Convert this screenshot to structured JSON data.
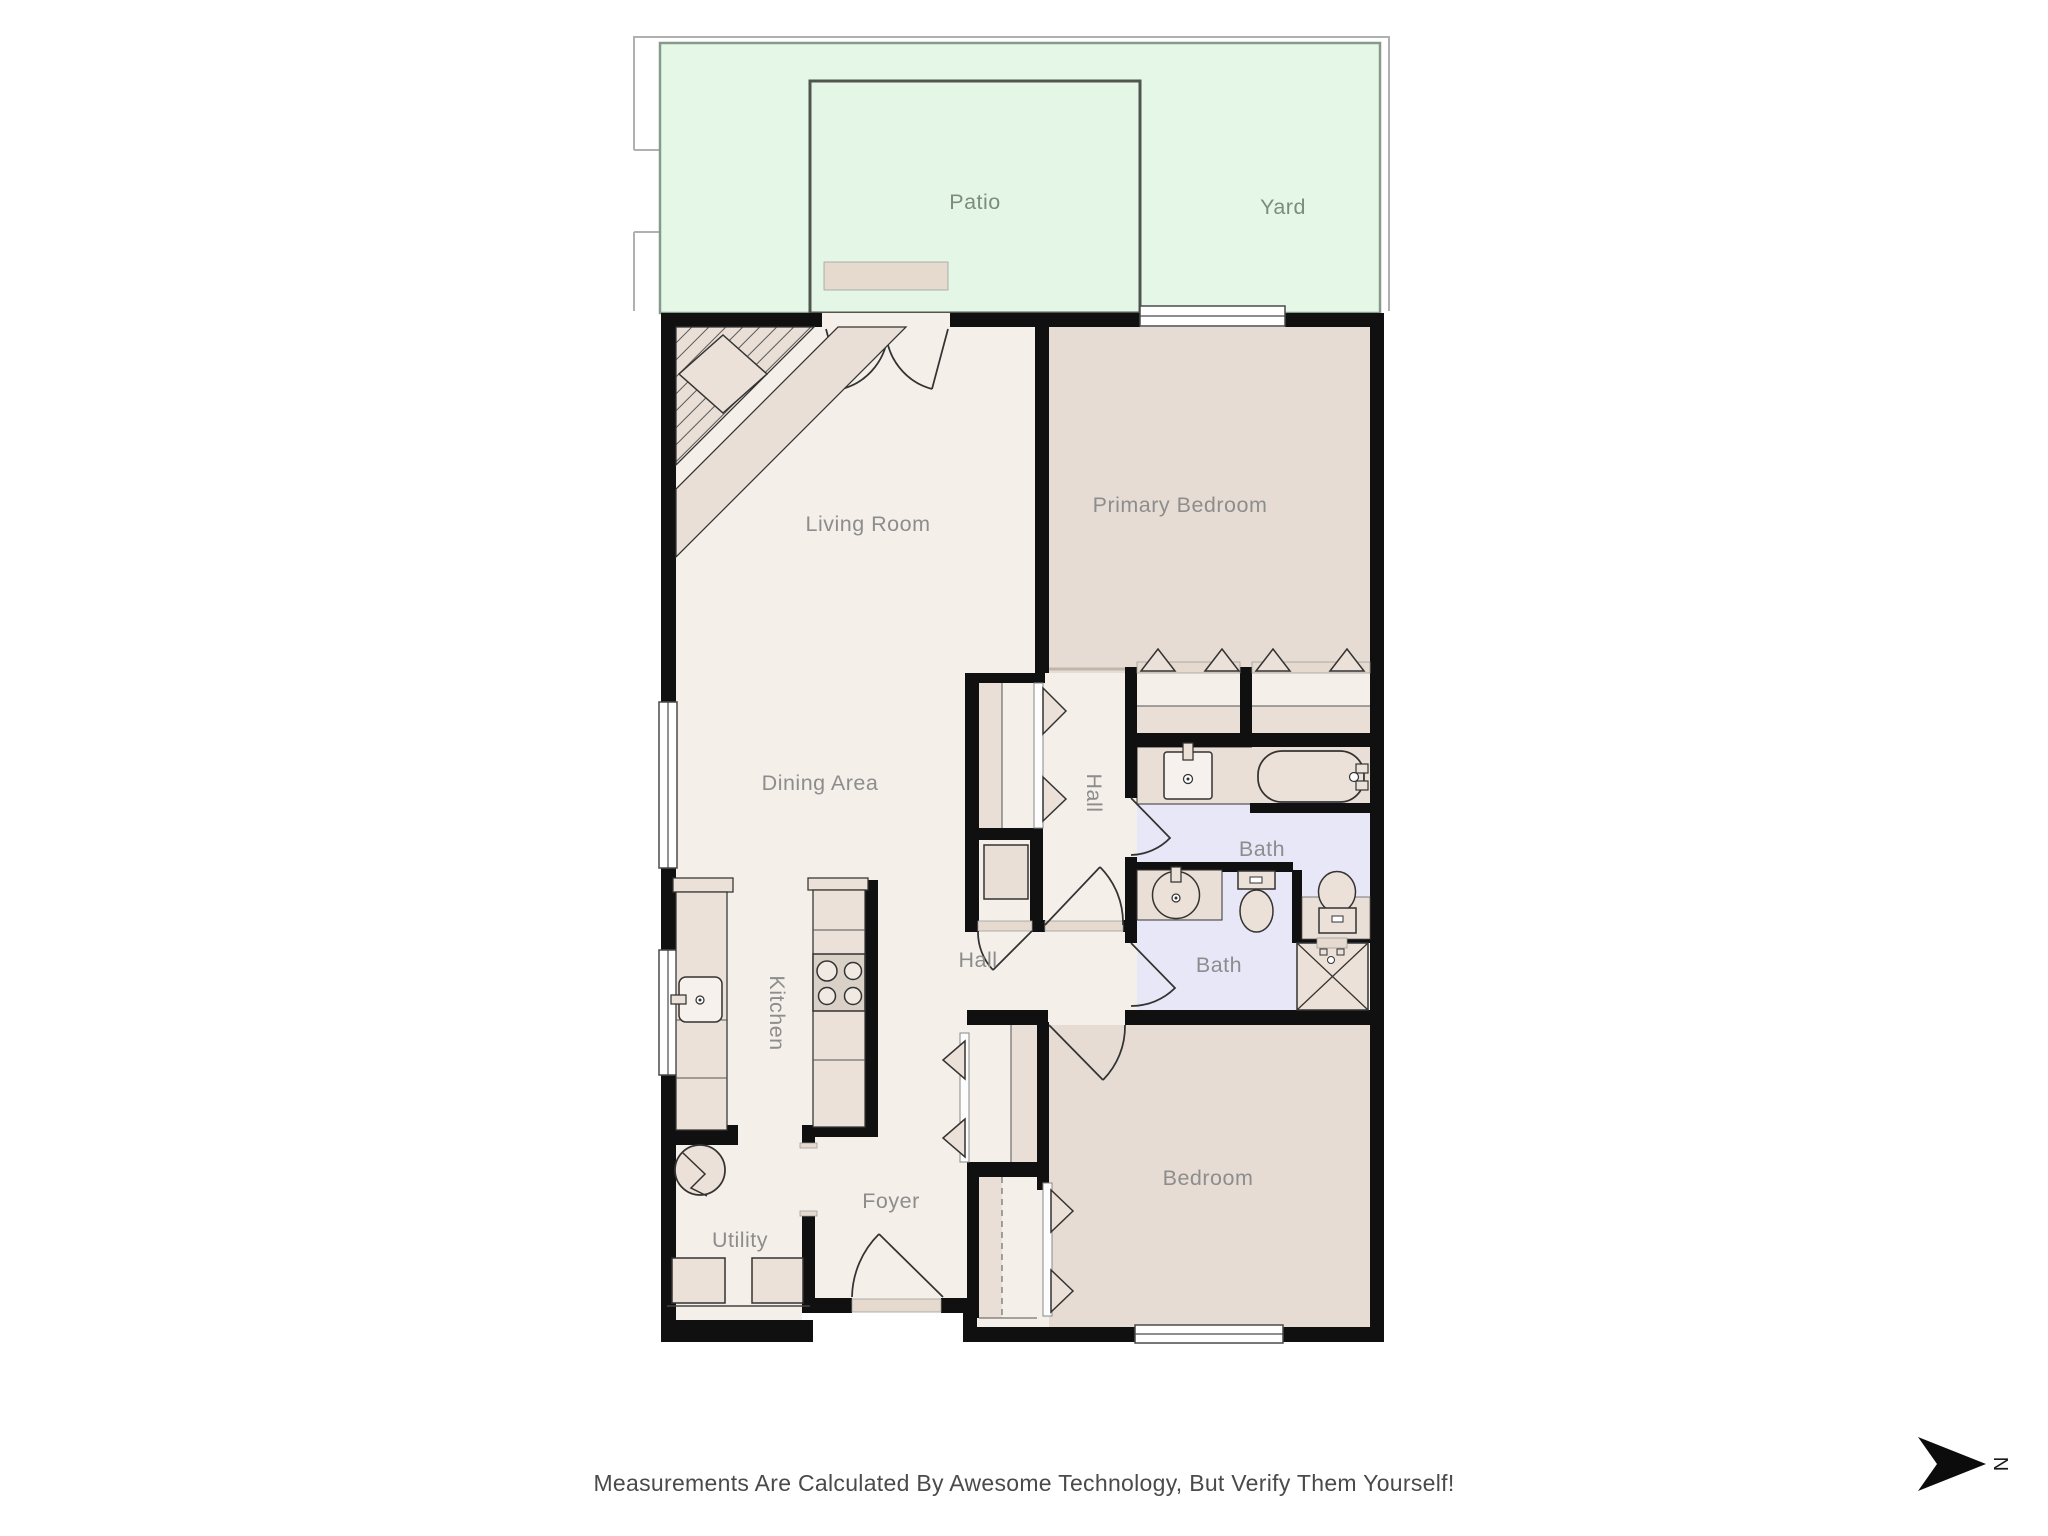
{
  "labels": {
    "patio": "Patio",
    "yard": "Yard",
    "living_room": "Living Room",
    "primary_bedroom": "Primary Bedroom",
    "dining_area": "Dining Area",
    "hall_upper": "Hall",
    "hall_lower": "Hall",
    "bath_upper": "Bath",
    "bath_lower": "Bath",
    "kitchen": "Kitchen",
    "foyer": "Foyer",
    "utility": "Utility",
    "bedroom": "Bedroom"
  },
  "footer": {
    "disclaimer": "Measurements Are Calculated By Awesome Technology, But Verify Them Yourself!"
  },
  "compass": {
    "north_label": "N"
  },
  "colors": {
    "wall": "#101010",
    "floor_light": "#f4efe9",
    "floor_bedroom": "#e6dcd4",
    "floor_bath": "#e8e7f7",
    "yard_fill": "#e5f8e7",
    "yard_border": "#879a89",
    "patio_border": "#50554e",
    "fixture_fill": "#ece1d8",
    "label_text": "#8d8d8d",
    "outdoor_label_text": "#7c8c7e",
    "footer_text": "#4a4a4a"
  }
}
